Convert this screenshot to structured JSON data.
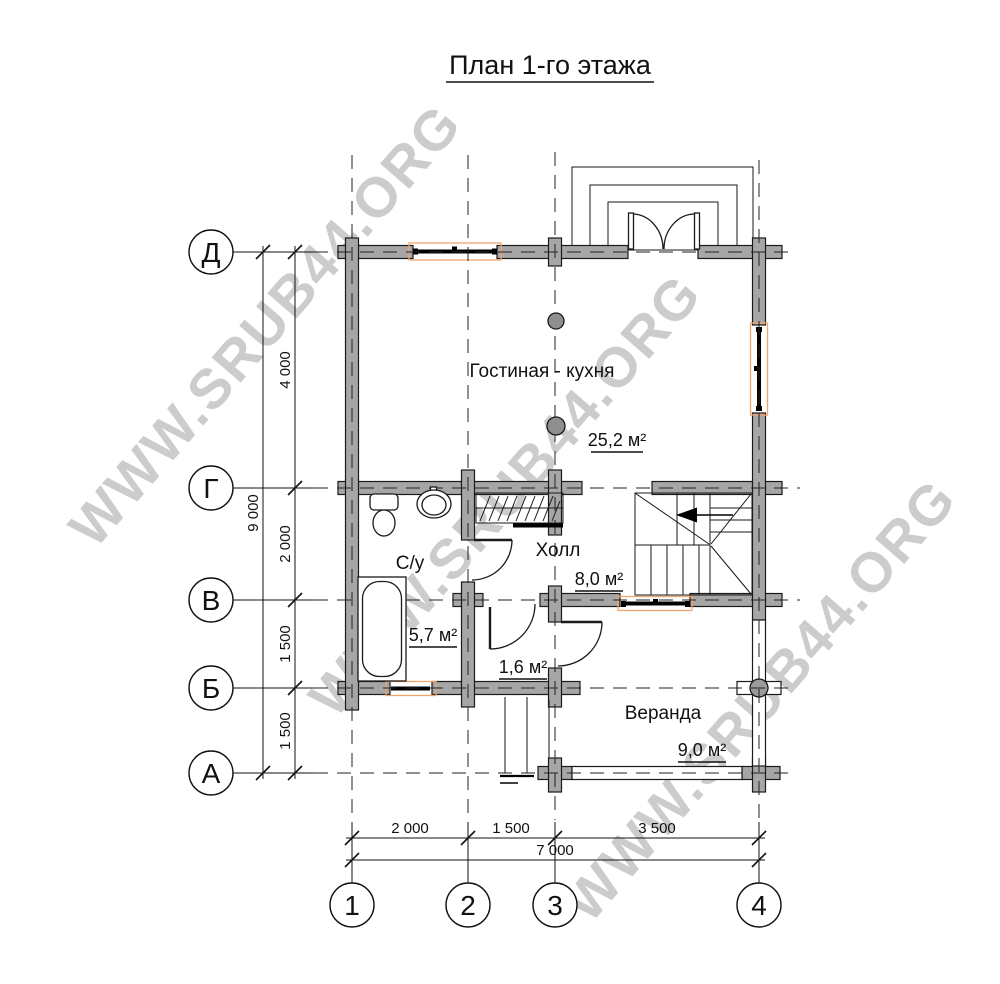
{
  "title": "План 1-го этажа",
  "watermark": "WWW.SRUB44.ORG",
  "grid": {
    "row_labels": [
      "Д",
      "Г",
      "В",
      "Б",
      "А"
    ],
    "col_labels": [
      "1",
      "2",
      "3",
      "4"
    ]
  },
  "dimensions": {
    "left_total": "9 000",
    "left_segments": [
      "4 000",
      "2 000",
      "1 500",
      "1 500"
    ],
    "bottom_segments": [
      "2 000",
      "1 500",
      "3 500"
    ],
    "bottom_total": "7 000"
  },
  "rooms": {
    "living_kitchen": {
      "name": "Гостиная - кухня",
      "area": "25,2 м²"
    },
    "hall": {
      "name": "Холл",
      "area": "8,0 м²"
    },
    "bathroom": {
      "name": "С/у",
      "area": "5,7 м²"
    },
    "tambour": {
      "area": "1,6 м²"
    },
    "veranda": {
      "name": "Веранда",
      "area": "9,0 м²"
    }
  },
  "colors": {
    "wall_fill": "#a6a6a6",
    "window_accent": "#f2a56b",
    "watermark_gray": "#cccccc"
  }
}
